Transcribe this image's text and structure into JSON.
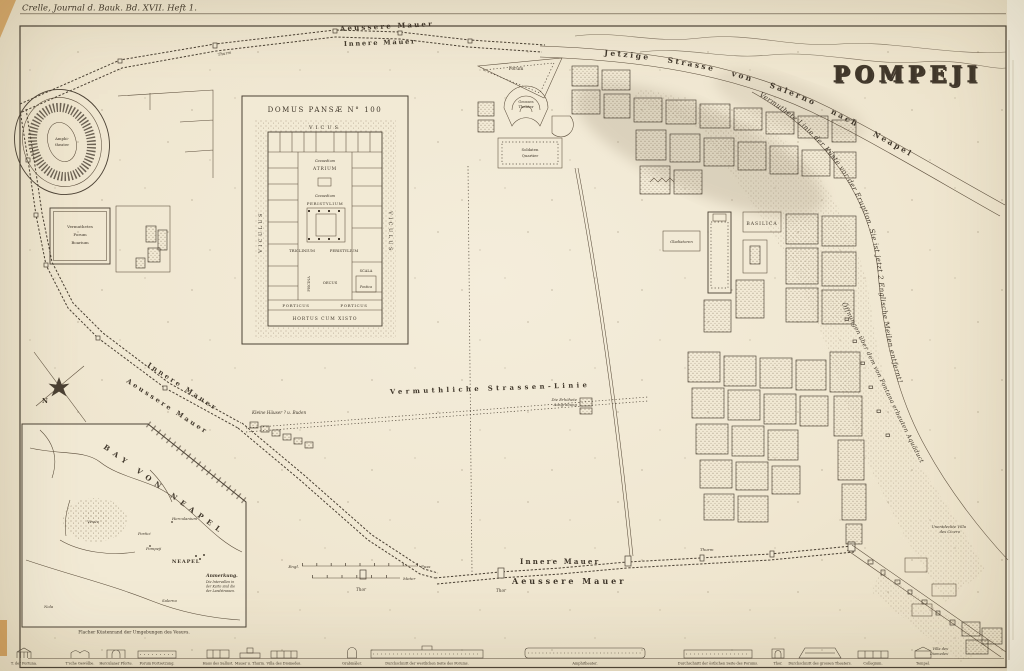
{
  "plate": {
    "journal_ref": "Crelle, Journal d. Bauk. Bd. XVII. Heft 1.",
    "title": "POMPEJI"
  },
  "compass": {
    "north": "N"
  },
  "walls": {
    "outer_top": "Aeussere Mauer",
    "inner_top": "Innere Mauer",
    "outer_left": "Aeussere Mauer",
    "inner_left": "Innere Mauer",
    "inner_bottom": "Innere Mauer",
    "outer_bottom": "Aeussere Mauer",
    "tower": "Thurm",
    "gate": "Thor"
  },
  "routes": {
    "salerno_road": "Jetzige Strasse von Salerno nach Neapel",
    "coast": "Vermuthete Linie der Küste vor der Eruption. Sie ist jetzt 2 Englische Meilen entfernt!",
    "aqueduct": "Öffnungen über dem von Fontana erbauten Aquäduct",
    "conjectural_street": "Vermuthliche Strassen-Linie"
  },
  "city": {
    "basilica": "BASILICA",
    "gladiators": "Gladiatoren",
    "triangular_forum": "Forum",
    "great_theatre_1": "Grosses",
    "great_theatre_2": "Theater",
    "soldiers_1": "Soldaten",
    "soldiers_2": "Quartier",
    "amphitheatre_1": "Amphi-",
    "amphitheatre_2": "theater",
    "forum_boarium_1": "Vermuthetes",
    "forum_boarium_2": "Forum",
    "forum_boarium_3": "Boarium",
    "raised_excavation_1": "Die Erhöhete",
    "raised_excavation_2": "Ausgrabung",
    "small_houses": "Kleine Häuser ? u. Buden",
    "cicero_1": "Unentdeckte Villa",
    "cicero_2": "des Cicero",
    "tombs_villa_1": "Villa des",
    "tombs_villa_2": "Diomedes"
  },
  "domus": {
    "title": "DOMUS PANSÆ N° 100",
    "vicus": "VICUS",
    "viculus_left": "VICULUS",
    "viculus_right": "VICULUS",
    "cavaedium_a": "Cavaedium",
    "atrium": "ATRIUM",
    "cavaedium_b": "Cavaedium",
    "peristylium_a": "PERISTYLIUM",
    "triclinium": "TRICLINIUM",
    "peristylium_b": "PERISTYLIUM",
    "piscina": "PISCINA",
    "oecus": "OECUS",
    "scala": "SCALA",
    "postica": "Postica",
    "porticus_a": "PORTICUS",
    "porticus_b": "PORTICUS",
    "hortus": "HORTUS CUM XISTO"
  },
  "bay": {
    "title": "BAY VON NEAPEL",
    "neapel": "NEAPEL",
    "vesuv": "Vesuv",
    "herculanium": "Herculanium",
    "portici": "Portici",
    "pompeji": "Pompeji",
    "nola": "Nola",
    "salerno": "Salerno",
    "note_title": "Anmerkung.",
    "note_1": "Die Intervallen in",
    "note_2": "der Karte sind die",
    "note_3": "der Landstrassen.",
    "caption": "Flacher Küstenrand der Umgebungen des Vesuvs."
  },
  "scale": {
    "engl": "Engl.",
    "fuss": "Fuss",
    "meter": "Meter"
  },
  "frieze": {
    "items": [
      {
        "c": "T. der Fortuna."
      },
      {
        "c": "T'sche Gewölbe."
      },
      {
        "c": "Herculaner Pforte."
      },
      {
        "c": "Forum Fortsetzung."
      },
      {
        "c": "Haus des Sallust."
      },
      {
        "c": "Mauer u. Thurm."
      },
      {
        "c": "Villa des Diomedes."
      },
      {
        "c": "Grabmäler."
      },
      {
        "c": "Durchschnitt der westlichen Seite des Forums."
      },
      {
        "c": "Amphitheater."
      },
      {
        "c": "Durchschnitt der östlichen Seite des Forums."
      },
      {
        "c": "Thor."
      },
      {
        "c": "Durchschnitt des grossen Theaters."
      },
      {
        "c": "Collegium."
      },
      {
        "c": "Tempel."
      }
    ]
  }
}
